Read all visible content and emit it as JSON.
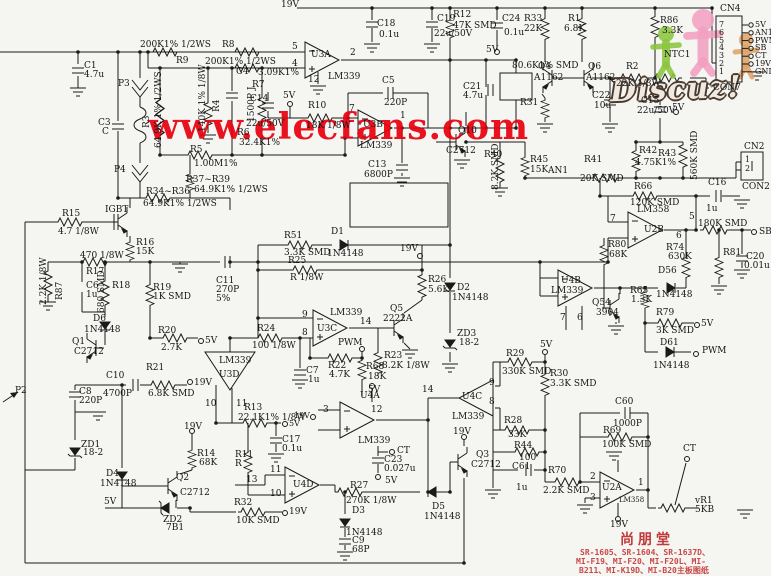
{
  "watermark": {
    "text": "www.elecfans.com",
    "color": "#e8000f"
  },
  "logo": {
    "text": "Discuz!"
  },
  "footer": {
    "title": "尚朋堂",
    "color": "#c03a3a",
    "lines": [
      "SR-1605、SR-1604、SR-1637D、",
      "MI-F19、MI-F20、MI-F20L、MI-",
      "B211、MI-K19D、MI-B20主板图纸"
    ]
  },
  "connectors": {
    "cn4": {
      "name": "CN4",
      "bottom_label": "CON7",
      "pins": [
        {
          "num": "7",
          "label": "5V"
        },
        {
          "num": "6",
          "label": "AN1"
        },
        {
          "num": "5",
          "label": "PWM"
        },
        {
          "num": "4",
          "label": "SB"
        },
        {
          "num": "3",
          "label": "CT"
        },
        {
          "num": "2",
          "label": "19V"
        },
        {
          "num": "1",
          "label": "GND"
        }
      ]
    },
    "cn2": {
      "name": "CN2",
      "bottom_label": "CON2",
      "pins": [
        {
          "num": "1"
        },
        {
          "num": "2"
        }
      ]
    }
  },
  "labels": [
    {
      "t": "19V",
      "x": 281,
      "y": 1
    },
    {
      "t": "C1",
      "x": 84,
      "y": 62
    },
    {
      "t": "4.7u",
      "x": 84,
      "y": 71
    },
    {
      "t": "C3",
      "x": 98,
      "y": 119
    },
    {
      "t": "C",
      "x": 102,
      "y": 128
    },
    {
      "t": "P3",
      "x": 118,
      "y": 80
    },
    {
      "t": "P4",
      "x": 114,
      "y": 166
    },
    {
      "t": "200K1% 1/2WS",
      "x": 140,
      "y": 41
    },
    {
      "t": "R8",
      "x": 222,
      "y": 41
    },
    {
      "t": "R9",
      "x": 176,
      "y": 57
    },
    {
      "t": "200K1% 1/2WS",
      "x": 205,
      "y": 58
    },
    {
      "t": "R3",
      "x": 143,
      "y": 128,
      "r": 1
    },
    {
      "t": "64.9K 1% 1/2WS",
      "x": 155,
      "y": 148,
      "r": 1
    },
    {
      "t": "R4",
      "x": 213,
      "y": 112,
      "r": 1
    },
    {
      "t": "140K 1% 1/8W",
      "x": 199,
      "y": 132,
      "r": 1
    },
    {
      "t": "C4",
      "x": 236,
      "y": 68
    },
    {
      "t": "1500P J",
      "x": 248,
      "y": 122,
      "r": 1
    },
    {
      "t": "3.09K1%",
      "x": 258,
      "y": 69
    },
    {
      "t": "R7",
      "x": 252,
      "y": 81
    },
    {
      "t": "R6",
      "x": 237,
      "y": 129
    },
    {
      "t": "32.4K1%",
      "x": 239,
      "y": 139
    },
    {
      "t": "R5",
      "x": 190,
      "y": 146
    },
    {
      "t": "1.00M1%",
      "x": 194,
      "y": 160
    },
    {
      "t": "R37~R39",
      "x": 186,
      "y": 176
    },
    {
      "t": "64.9K1% 1/2WS",
      "x": 194,
      "y": 186
    },
    {
      "t": "R34~R36",
      "x": 146,
      "y": 188
    },
    {
      "t": "64.9K1% 1/2WS",
      "x": 143,
      "y": 200
    },
    {
      "t": "R15",
      "x": 62,
      "y": 210
    },
    {
      "t": "4.7 1/8W",
      "x": 58,
      "y": 228
    },
    {
      "t": "IGBT",
      "x": 105,
      "y": 206
    },
    {
      "t": "R16",
      "x": 136,
      "y": 239
    },
    {
      "t": "15K",
      "x": 136,
      "y": 248
    },
    {
      "t": "470 1/8W",
      "x": 80,
      "y": 252
    },
    {
      "t": "R17",
      "x": 86,
      "y": 268
    },
    {
      "t": "R87",
      "x": 56,
      "y": 300,
      "r": 1
    },
    {
      "t": "2.2K 1/8W",
      "x": 40,
      "y": 305,
      "r": 1
    },
    {
      "t": "C6",
      "x": 86,
      "y": 282
    },
    {
      "t": "1u",
      "x": 86,
      "y": 291
    },
    {
      "t": "R18",
      "x": 112,
      "y": 282
    },
    {
      "t": "680 SMD",
      "x": 98,
      "y": 313,
      "r": 1
    },
    {
      "t": "R19",
      "x": 153,
      "y": 284
    },
    {
      "t": "1K SMD",
      "x": 153,
      "y": 293
    },
    {
      "t": "D6",
      "x": 93,
      "y": 315
    },
    {
      "t": "1N4148",
      "x": 84,
      "y": 326
    },
    {
      "t": "Q1",
      "x": 72,
      "y": 338
    },
    {
      "t": "C2712",
      "x": 74,
      "y": 348
    },
    {
      "t": "R20",
      "x": 158,
      "y": 327
    },
    {
      "t": "2.7K",
      "x": 161,
      "y": 344
    },
    {
      "t": "5V",
      "x": 205,
      "y": 337
    },
    {
      "t": "R21",
      "x": 146,
      "y": 364
    },
    {
      "t": "6.8K SMD",
      "x": 148,
      "y": 390
    },
    {
      "t": "19V",
      "x": 194,
      "y": 379
    },
    {
      "t": "C10",
      "x": 106,
      "y": 372
    },
    {
      "t": "4700P",
      "x": 103,
      "y": 390
    },
    {
      "t": "C8",
      "x": 79,
      "y": 388
    },
    {
      "t": "220P",
      "x": 79,
      "y": 397
    },
    {
      "t": "C11",
      "x": 216,
      "y": 277
    },
    {
      "t": "270P",
      "x": 216,
      "y": 286
    },
    {
      "t": "5%",
      "x": 216,
      "y": 295
    },
    {
      "t": "ZD1",
      "x": 81,
      "y": 441
    },
    {
      "t": "18-2",
      "x": 83,
      "y": 449
    },
    {
      "t": "D4",
      "x": 106,
      "y": 470
    },
    {
      "t": "1N4148",
      "x": 100,
      "y": 480
    },
    {
      "t": "Q2",
      "x": 176,
      "y": 474
    },
    {
      "t": "C2712",
      "x": 180,
      "y": 489
    },
    {
      "t": "R14",
      "x": 197,
      "y": 450
    },
    {
      "t": "68K",
      "x": 199,
      "y": 459
    },
    {
      "t": "19V",
      "x": 184,
      "y": 423
    },
    {
      "t": "ZD2",
      "x": 163,
      "y": 516
    },
    {
      "t": "7B1",
      "x": 166,
      "y": 524
    },
    {
      "t": "5V",
      "x": 104,
      "y": 498
    },
    {
      "t": "R32",
      "x": 234,
      "y": 499
    },
    {
      "t": "10K SMD",
      "x": 236,
      "y": 517
    },
    {
      "t": "19V",
      "x": 289,
      "y": 508
    },
    {
      "t": "P2",
      "x": 15,
      "y": 387
    },
    {
      "t": "R51",
      "x": 284,
      "y": 232
    },
    {
      "t": "3.3K SMD",
      "x": 284,
      "y": 249
    },
    {
      "t": "D1",
      "x": 331,
      "y": 228
    },
    {
      "t": "1N4148",
      "x": 327,
      "y": 250
    },
    {
      "t": "R25",
      "x": 288,
      "y": 257
    },
    {
      "t": "R 1/8W",
      "x": 290,
      "y": 274
    },
    {
      "t": "19V",
      "x": 400,
      "y": 245
    },
    {
      "t": "R26",
      "x": 428,
      "y": 276
    },
    {
      "t": "5.6K",
      "x": 428,
      "y": 286
    },
    {
      "t": "D2",
      "x": 457,
      "y": 284
    },
    {
      "t": "1N4148",
      "x": 452,
      "y": 294
    },
    {
      "t": "ZD3",
      "x": 457,
      "y": 330
    },
    {
      "t": "18-2",
      "x": 459,
      "y": 339
    },
    {
      "t": "LM339",
      "x": 330,
      "y": 309
    },
    {
      "t": "U3C",
      "x": 317,
      "y": 325
    },
    {
      "t": "9",
      "x": 302,
      "y": 311
    },
    {
      "t": "8",
      "x": 302,
      "y": 329
    },
    {
      "t": "14",
      "x": 360,
      "y": 318
    },
    {
      "t": "Q5",
      "x": 390,
      "y": 305
    },
    {
      "t": "2222A",
      "x": 383,
      "y": 315
    },
    {
      "t": "R24",
      "x": 257,
      "y": 325
    },
    {
      "t": "100 1/8W",
      "x": 252,
      "y": 342
    },
    {
      "t": "PWM",
      "x": 338,
      "y": 339
    },
    {
      "t": "R22",
      "x": 328,
      "y": 362
    },
    {
      "t": "4.7K",
      "x": 329,
      "y": 371
    },
    {
      "t": "R68",
      "x": 366,
      "y": 363
    },
    {
      "t": "18K",
      "x": 368,
      "y": 373
    },
    {
      "t": "R23",
      "x": 384,
      "y": 352
    },
    {
      "t": "8.2K 1/8W",
      "x": 382,
      "y": 362
    },
    {
      "t": "5V",
      "x": 368,
      "y": 386
    },
    {
      "t": "C7",
      "x": 306,
      "y": 367
    },
    {
      "t": "1u",
      "x": 308,
      "y": 376
    },
    {
      "t": "LM339",
      "x": 219,
      "y": 357
    },
    {
      "t": "U3D",
      "x": 219,
      "y": 371
    },
    {
      "t": "10",
      "x": 205,
      "y": 400
    },
    {
      "t": "11",
      "x": 236,
      "y": 400
    },
    {
      "t": "R13",
      "x": 244,
      "y": 404
    },
    {
      "t": "22.1K1% 1/8W",
      "x": 238,
      "y": 414
    },
    {
      "t": "5V",
      "x": 289,
      "y": 420,
      "s": 8
    },
    {
      "t": "C17",
      "x": 282,
      "y": 436
    },
    {
      "t": "0.1u",
      "x": 282,
      "y": 445
    },
    {
      "t": "R11",
      "x": 235,
      "y": 451
    },
    {
      "t": "R",
      "x": 235,
      "y": 460
    },
    {
      "t": "13",
      "x": 246,
      "y": 476
    },
    {
      "t": "11",
      "x": 270,
      "y": 466
    },
    {
      "t": "10",
      "x": 270,
      "y": 490
    },
    {
      "t": "U4D",
      "x": 293,
      "y": 481
    },
    {
      "t": "R27",
      "x": 350,
      "y": 482
    },
    {
      "t": "270K 1/8W",
      "x": 346,
      "y": 497
    },
    {
      "t": "D3",
      "x": 352,
      "y": 507
    },
    {
      "t": "1N4148",
      "x": 346,
      "y": 529
    },
    {
      "t": "C9",
      "x": 352,
      "y": 537
    },
    {
      "t": "68P",
      "x": 352,
      "y": 546
    },
    {
      "t": "D5",
      "x": 432,
      "y": 503
    },
    {
      "t": "1N4148",
      "x": 424,
      "y": 513
    },
    {
      "t": "U4A",
      "x": 360,
      "y": 392
    },
    {
      "t": "LM339",
      "x": 358,
      "y": 437
    },
    {
      "t": "3",
      "x": 323,
      "y": 406
    },
    {
      "t": "12",
      "x": 371,
      "y": 406
    },
    {
      "t": "19V",
      "x": 294,
      "y": 412,
      "s": 8
    },
    {
      "t": "C23",
      "x": 384,
      "y": 456
    },
    {
      "t": "0.027u",
      "x": 384,
      "y": 465
    },
    {
      "t": "CT",
      "x": 397,
      "y": 447
    },
    {
      "t": "5V",
      "x": 385,
      "y": 477
    },
    {
      "t": "U4C",
      "x": 462,
      "y": 393
    },
    {
      "t": "LM339",
      "x": 452,
      "y": 413
    },
    {
      "t": "14",
      "x": 422,
      "y": 386
    },
    {
      "t": "9",
      "x": 489,
      "y": 379
    },
    {
      "t": "8",
      "x": 489,
      "y": 398
    },
    {
      "t": "19V",
      "x": 453,
      "y": 428
    },
    {
      "t": "Q3",
      "x": 476,
      "y": 451
    },
    {
      "t": "C2712",
      "x": 471,
      "y": 461
    },
    {
      "t": "U3A",
      "x": 311,
      "y": 51
    },
    {
      "t": "LM339",
      "x": 328,
      "y": 73
    },
    {
      "t": "5",
      "x": 292,
      "y": 43
    },
    {
      "t": "4",
      "x": 292,
      "y": 60
    },
    {
      "t": "2",
      "x": 350,
      "y": 49
    },
    {
      "t": "12",
      "x": 308,
      "y": 76
    },
    {
      "t": "C18",
      "x": 377,
      "y": 20
    },
    {
      "t": "0.1u",
      "x": 379,
      "y": 31
    },
    {
      "t": "C19",
      "x": 437,
      "y": 15
    },
    {
      "t": "22u/50V",
      "x": 434,
      "y": 30
    },
    {
      "t": "R12",
      "x": 453,
      "y": 11
    },
    {
      "t": "47K SMD",
      "x": 453,
      "y": 22
    },
    {
      "t": "C24",
      "x": 502,
      "y": 15
    },
    {
      "t": "0.1u",
      "x": 504,
      "y": 29
    },
    {
      "t": "5V",
      "x": 486,
      "y": 46
    },
    {
      "t": "5V",
      "x": 283,
      "y": 92
    },
    {
      "t": "C14",
      "x": 250,
      "y": 95
    },
    {
      "t": "22u/50V",
      "x": 246,
      "y": 120
    },
    {
      "t": "R10",
      "x": 308,
      "y": 102
    },
    {
      "t": "18K 1/8W",
      "x": 306,
      "y": 122
    },
    {
      "t": "U3B",
      "x": 363,
      "y": 121
    },
    {
      "t": "LM339",
      "x": 360,
      "y": 142
    },
    {
      "t": "7",
      "x": 349,
      "y": 105
    },
    {
      "t": "1",
      "x": 400,
      "y": 112
    },
    {
      "t": "C5",
      "x": 382,
      "y": 77
    },
    {
      "t": "220P",
      "x": 384,
      "y": 99
    },
    {
      "t": "C13",
      "x": 368,
      "y": 161
    },
    {
      "t": "6800P",
      "x": 364,
      "y": 171
    },
    {
      "t": "Q10",
      "x": 458,
      "y": 127
    },
    {
      "t": "C2712",
      "x": 446,
      "y": 147
    },
    {
      "t": "R40",
      "x": 484,
      "y": 151
    },
    {
      "t": "8.2K SMD",
      "x": 492,
      "y": 190,
      "r": 1
    },
    {
      "t": "R45",
      "x": 530,
      "y": 156
    },
    {
      "t": "15K",
      "x": 530,
      "y": 166
    },
    {
      "t": "AN1",
      "x": 548,
      "y": 167
    },
    {
      "t": "80.6K1% SMD",
      "x": 512,
      "y": 62
    },
    {
      "t": "C21",
      "x": 463,
      "y": 83
    },
    {
      "t": "4.7u",
      "x": 463,
      "y": 92
    },
    {
      "t": "R33",
      "x": 524,
      "y": 15
    },
    {
      "t": "22K",
      "x": 524,
      "y": 25
    },
    {
      "t": "R1",
      "x": 568,
      "y": 15
    },
    {
      "t": "6.8K",
      "x": 564,
      "y": 25
    },
    {
      "t": "R86",
      "x": 660,
      "y": 17
    },
    {
      "t": "3.3K",
      "x": 662,
      "y": 27
    },
    {
      "t": "Q4",
      "x": 538,
      "y": 63
    },
    {
      "t": "A1162",
      "x": 534,
      "y": 74
    },
    {
      "t": "Q6",
      "x": 588,
      "y": 63
    },
    {
      "t": "A1162",
      "x": 586,
      "y": 74
    },
    {
      "t": "R2",
      "x": 626,
      "y": 63
    },
    {
      "t": "22K 1/8W",
      "x": 616,
      "y": 80
    },
    {
      "t": "NTC1",
      "x": 664,
      "y": 51
    },
    {
      "t": "R31",
      "x": 520,
      "y": 99
    },
    {
      "t": "C22",
      "x": 592,
      "y": 92
    },
    {
      "t": "10u",
      "x": 594,
      "y": 102
    },
    {
      "t": "C15",
      "x": 641,
      "y": 97
    },
    {
      "t": "22u/50V",
      "x": 637,
      "y": 107
    },
    {
      "t": "5V",
      "x": 672,
      "y": 104
    },
    {
      "t": "R42",
      "x": 639,
      "y": 147
    },
    {
      "t": "4.75K1%",
      "x": 635,
      "y": 159
    },
    {
      "t": "R43",
      "x": 658,
      "y": 150
    },
    {
      "t": "560K SMD",
      "x": 691,
      "y": 180,
      "r": 1
    },
    {
      "t": "R41",
      "x": 584,
      "y": 156
    },
    {
      "t": "20K SMD",
      "x": 580,
      "y": 175
    },
    {
      "t": "R66",
      "x": 634,
      "y": 183
    },
    {
      "t": "120K SMD",
      "x": 630,
      "y": 199
    },
    {
      "t": "C16",
      "x": 708,
      "y": 179
    },
    {
      "t": "1u",
      "x": 706,
      "y": 205
    },
    {
      "t": "LM358",
      "x": 637,
      "y": 206
    },
    {
      "t": "U2B",
      "x": 644,
      "y": 226
    },
    {
      "t": "7",
      "x": 610,
      "y": 215
    },
    {
      "t": "5",
      "x": 689,
      "y": 213
    },
    {
      "t": "6",
      "x": 676,
      "y": 232
    },
    {
      "t": "180K SMD",
      "x": 698,
      "y": 220
    },
    {
      "t": "SB",
      "x": 759,
      "y": 228
    },
    {
      "t": "R80",
      "x": 608,
      "y": 241
    },
    {
      "t": "68K",
      "x": 609,
      "y": 251
    },
    {
      "t": "R74",
      "x": 666,
      "y": 244
    },
    {
      "t": "630K",
      "x": 668,
      "y": 253
    },
    {
      "t": "R81",
      "x": 723,
      "y": 249
    },
    {
      "t": "C20",
      "x": 746,
      "y": 253
    },
    {
      "t": "0.01u",
      "x": 744,
      "y": 262
    },
    {
      "t": "D56",
      "x": 658,
      "y": 267
    },
    {
      "t": "1N4148",
      "x": 656,
      "y": 291
    },
    {
      "t": "Q54",
      "x": 592,
      "y": 299
    },
    {
      "t": "3904",
      "x": 596,
      "y": 309
    },
    {
      "t": "R65",
      "x": 630,
      "y": 287
    },
    {
      "t": "1.3K",
      "x": 631,
      "y": 296
    },
    {
      "t": "R79",
      "x": 656,
      "y": 309
    },
    {
      "t": "3K SMD",
      "x": 656,
      "y": 327
    },
    {
      "t": "5V",
      "x": 701,
      "y": 320
    },
    {
      "t": "D61",
      "x": 660,
      "y": 339
    },
    {
      "t": "1N4148",
      "x": 653,
      "y": 362
    },
    {
      "t": "PWM",
      "x": 702,
      "y": 347
    },
    {
      "t": "U4B",
      "x": 561,
      "y": 277
    },
    {
      "t": "LM339",
      "x": 551,
      "y": 287
    },
    {
      "t": "7",
      "x": 560,
      "y": 314
    },
    {
      "t": "6",
      "x": 577,
      "y": 314
    },
    {
      "t": "R29",
      "x": 506,
      "y": 350
    },
    {
      "t": "330K SMD",
      "x": 502,
      "y": 368
    },
    {
      "t": "5V",
      "x": 540,
      "y": 341
    },
    {
      "t": "R30",
      "x": 550,
      "y": 370
    },
    {
      "t": "3.3K SMD",
      "x": 550,
      "y": 380
    },
    {
      "t": "R28",
      "x": 504,
      "y": 417
    },
    {
      "t": "33K",
      "x": 508,
      "y": 431
    },
    {
      "t": "R44",
      "x": 514,
      "y": 442
    },
    {
      "t": "100",
      "x": 519,
      "y": 454
    },
    {
      "t": "C61",
      "x": 512,
      "y": 463
    },
    {
      "t": "1u",
      "x": 516,
      "y": 484
    },
    {
      "t": "R70",
      "x": 548,
      "y": 467
    },
    {
      "t": "2.2K SMD",
      "x": 543,
      "y": 487
    },
    {
      "t": "C60",
      "x": 615,
      "y": 398
    },
    {
      "t": "1000P",
      "x": 613,
      "y": 420
    },
    {
      "t": "R69",
      "x": 603,
      "y": 427
    },
    {
      "t": "100K SMD",
      "x": 602,
      "y": 441
    },
    {
      "t": "U2A",
      "x": 602,
      "y": 484
    },
    {
      "t": "LM358",
      "x": 619,
      "y": 497,
      "s": 7
    },
    {
      "t": "2",
      "x": 590,
      "y": 473
    },
    {
      "t": "3",
      "x": 590,
      "y": 494
    },
    {
      "t": "1",
      "x": 638,
      "y": 479
    },
    {
      "t": "19V",
      "x": 610,
      "y": 521
    },
    {
      "t": "vR1",
      "x": 695,
      "y": 497
    },
    {
      "t": "5KB",
      "x": 695,
      "y": 506
    },
    {
      "t": "CT",
      "x": 683,
      "y": 445
    }
  ]
}
